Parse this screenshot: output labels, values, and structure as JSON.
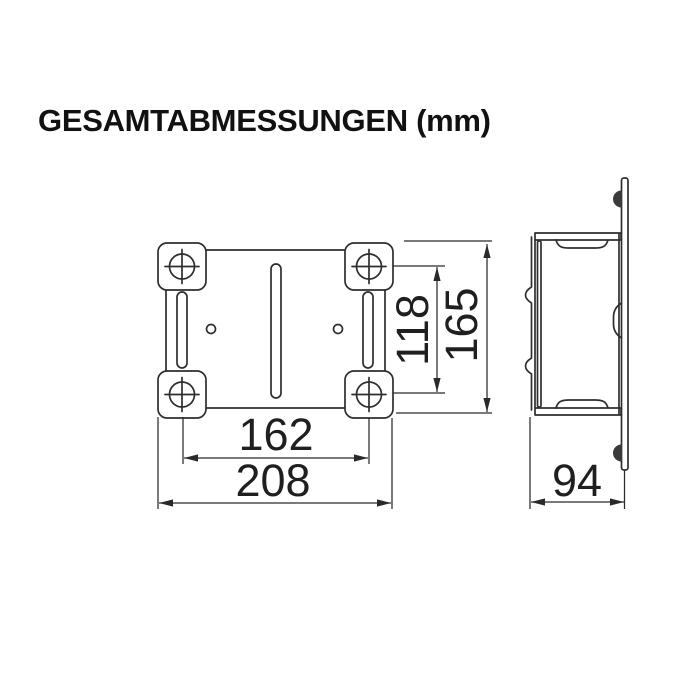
{
  "title": "GESAMTABMESSUNGEN (mm)",
  "unit": "mm",
  "drawing": {
    "type": "technical-dimension-drawing",
    "views": [
      "front-view-mounting-plate",
      "side-profile-view"
    ],
    "dimensions": {
      "hole_pitch_vertical": "118",
      "overall_height": "165",
      "hole_pitch_horizontal": "162",
      "overall_width": "208",
      "depth": "94"
    }
  },
  "colors": {
    "background": "#ffffff",
    "line": "#2e2e2e",
    "dimension_line": "#2a2a2a",
    "text": "#1f1f1f",
    "title": "#111111"
  }
}
